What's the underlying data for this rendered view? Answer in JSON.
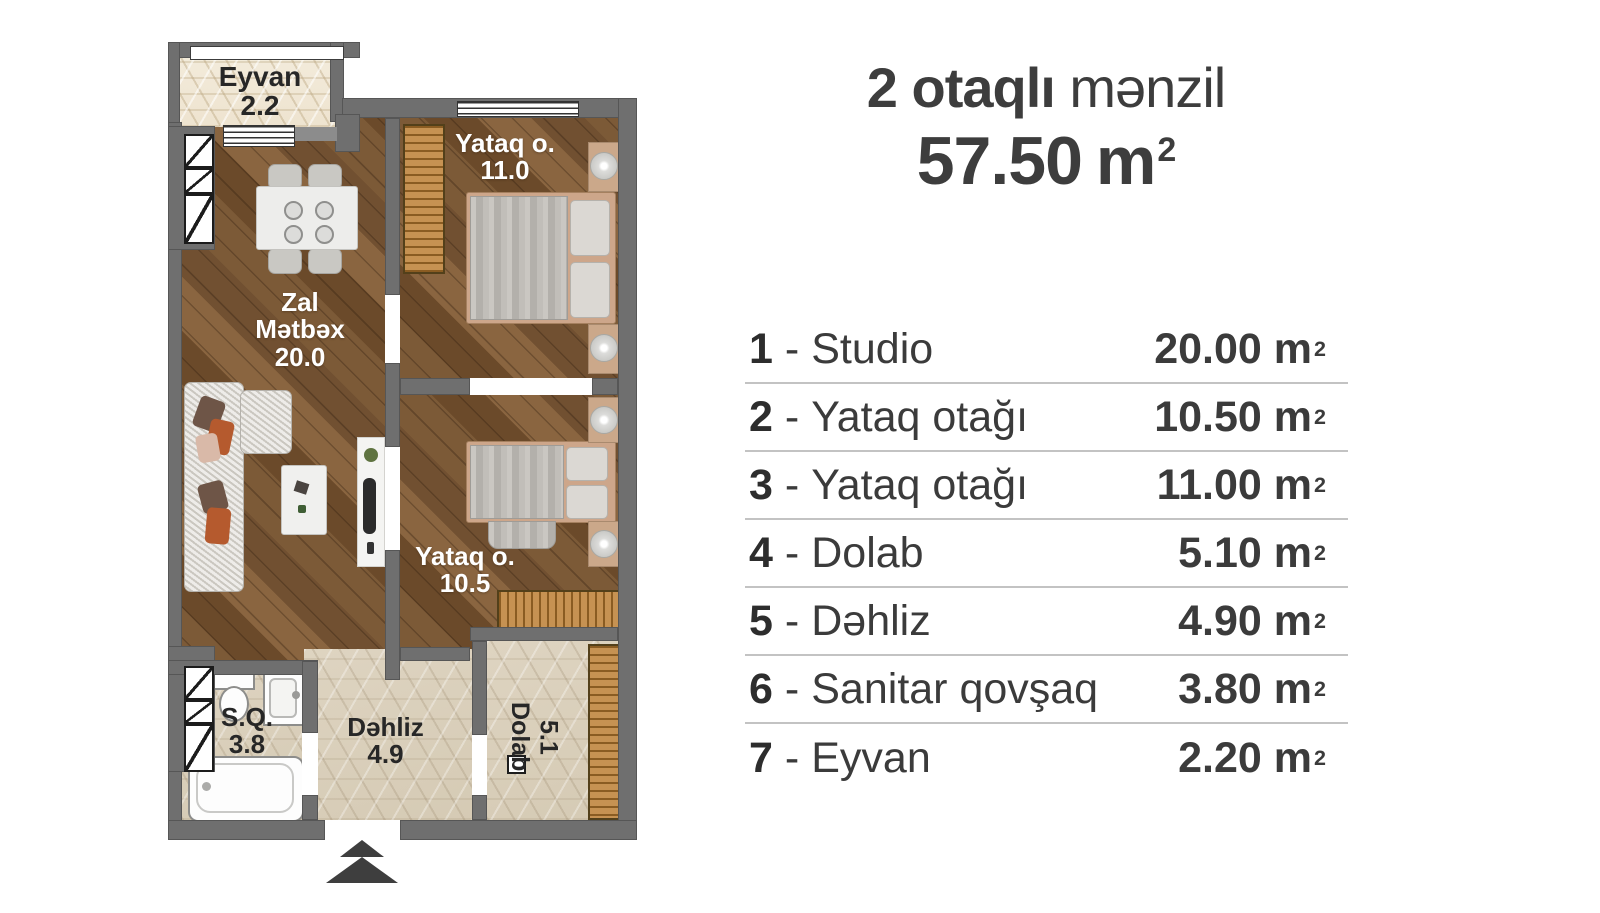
{
  "title": {
    "count_bold": "2 otaqlı",
    "rest": "mənzil",
    "area": "57.50",
    "unit": "m",
    "sup": "2"
  },
  "legend": {
    "dash": "-",
    "unit": "m",
    "sup": "2",
    "rows": [
      {
        "num": "1",
        "label": "Studio",
        "area": "20.00"
      },
      {
        "num": "2",
        "label": "Yataq otağı",
        "area": "10.50"
      },
      {
        "num": "3",
        "label": "Yataq otağı",
        "area": "11.00"
      },
      {
        "num": "4",
        "label": "Dolab",
        "area": "5.10"
      },
      {
        "num": "5",
        "label": "Dəhliz",
        "area": "4.90"
      },
      {
        "num": "6",
        "label": "Sanitar qovşaq",
        "area": "3.80"
      },
      {
        "num": "7",
        "label": "Eyvan",
        "area": "2.20"
      }
    ]
  },
  "plan": {
    "eyvan": {
      "label": "Eyvan",
      "area": "2.2"
    },
    "zal": {
      "line1": "Zal",
      "line2": "Mətbəx",
      "area": "20.0"
    },
    "yataq1": {
      "label": "Yataq o.",
      "area": "11.0"
    },
    "yataq2": {
      "label": "Yataq o.",
      "area": "10.5"
    },
    "sq": {
      "label": "S.Q.",
      "area": "3.8"
    },
    "dehliz": {
      "label": "Dəhliz",
      "area": "4.9"
    },
    "dolab": {
      "label": "Dolab",
      "area": "5.1"
    }
  },
  "colors": {
    "wall": "#6f6f6f",
    "wood_floor": "#77552f",
    "tile_floor": "#ddd3c0",
    "balcony_tile": "#f2ebdb",
    "wardrobe": "#c69252",
    "text_dark": "#3b3b3b",
    "separator": "#c3c3c3",
    "arrow": "#3e3e3e"
  }
}
